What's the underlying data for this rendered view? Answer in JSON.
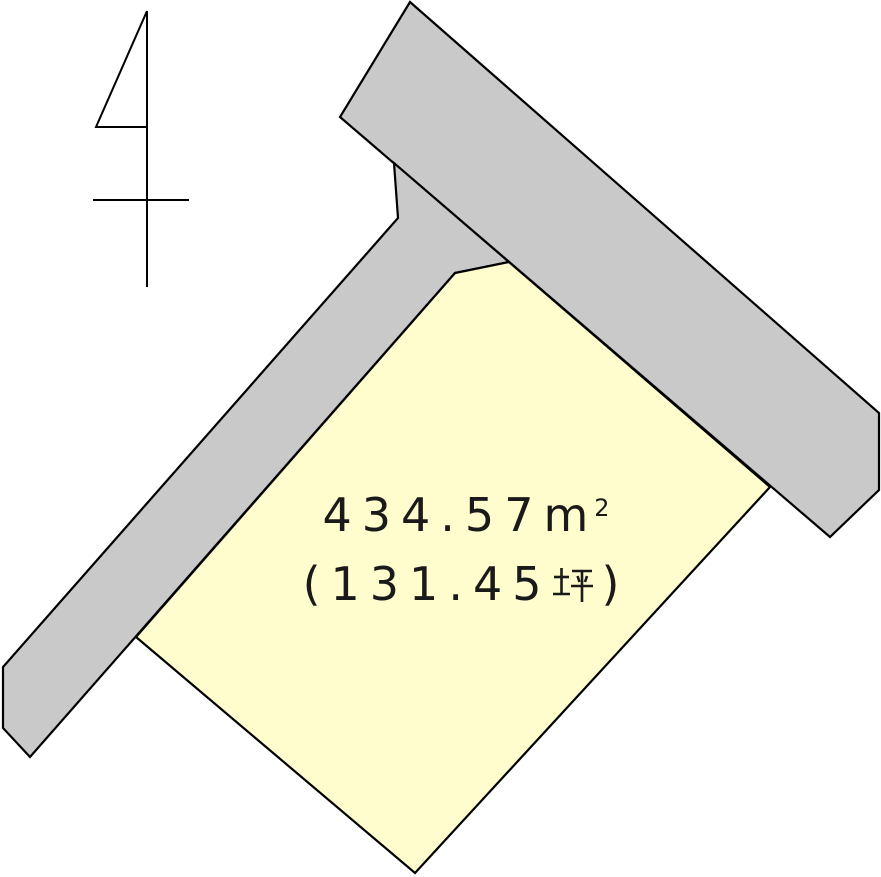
{
  "colors": {
    "background": "#FFFFFF",
    "road_fill": "#C9C9C9",
    "parcel_fill": "#FFFCCD",
    "outline": "#000000",
    "text": "#1A1A1A"
  },
  "parcel": {
    "area_sqm": "434.57",
    "area_unit_letter": "m",
    "area_unit_exponent": "2",
    "area_sqm_display": "４３４.５７㎡",
    "paren_open": "(",
    "area_tsubo": "131.45",
    "tsubo_unit": "坪",
    "paren_close": ")",
    "area_tsubo_display": "（１３１.４５坪）"
  }
}
